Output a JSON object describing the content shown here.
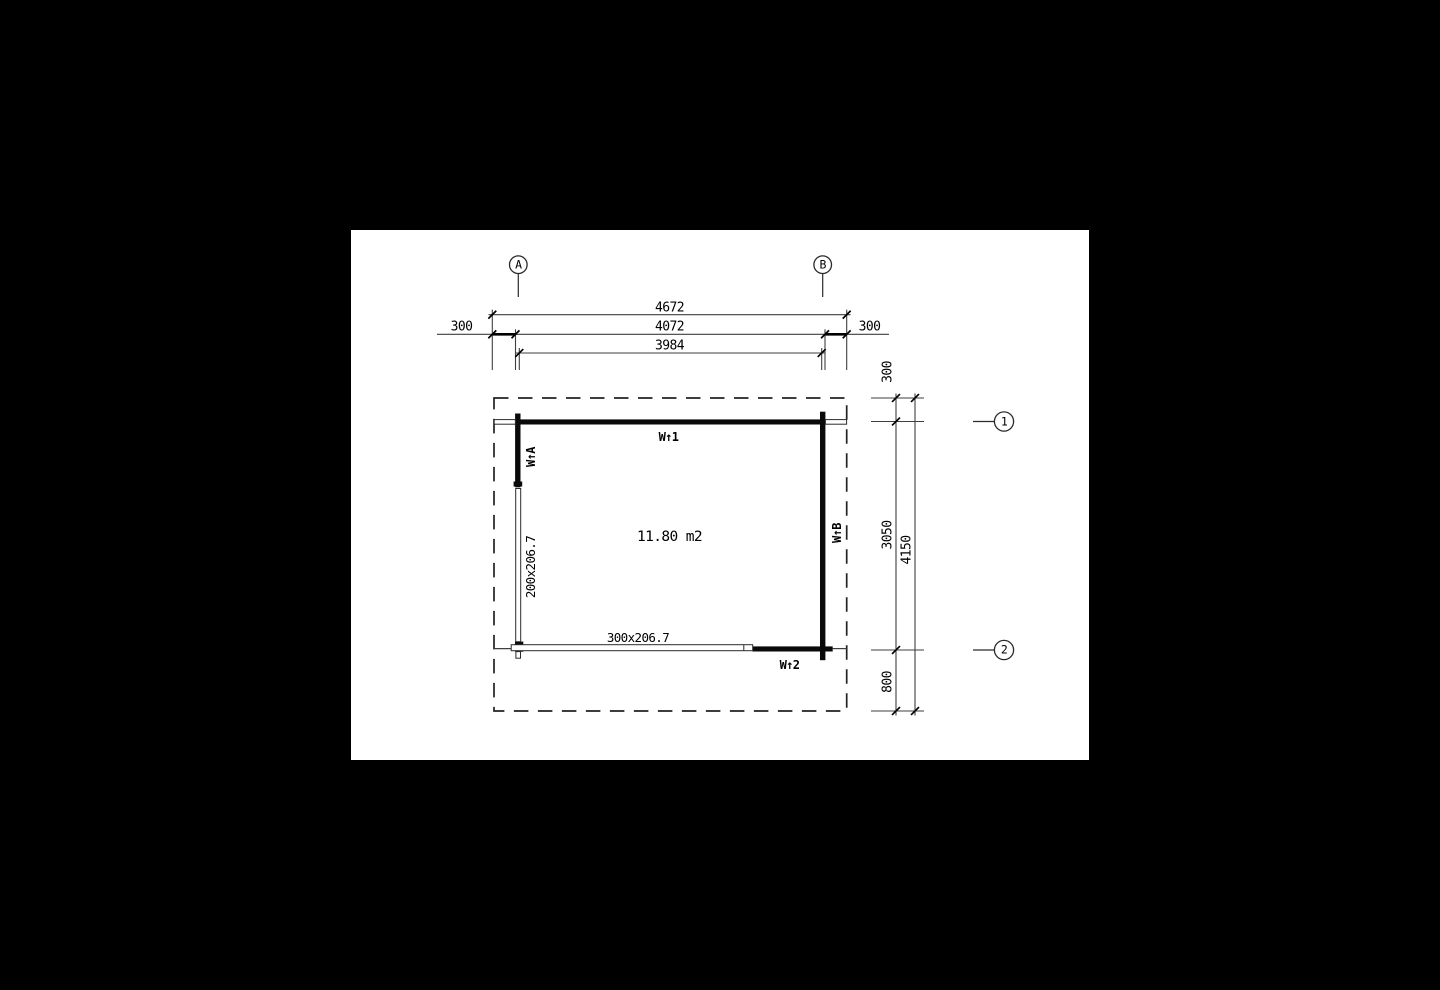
{
  "plan": {
    "area_label": "11.80 m2",
    "grid": {
      "a": "A",
      "b": "B",
      "one": "1",
      "two": "2"
    },
    "dims_top": {
      "overall": "4672",
      "outer": "4072",
      "inner": "3984",
      "offset_left": "300",
      "offset_right": "300"
    },
    "dims_right": {
      "offset_top": "300",
      "span": "3050",
      "offset_bottom": "800",
      "overall": "4150"
    },
    "windows": {
      "left": "200x206.7",
      "bottom": "300x206.7"
    },
    "wall_labels": {
      "w1": "W↑1",
      "w2": "W↑2",
      "wa": "W↑A",
      "wb": "W↑B"
    },
    "colors": {
      "paper": "#ffffff",
      "page_background": "#000000",
      "wall": "#0a0a0a",
      "thin_line": "#3f3f3f"
    }
  }
}
